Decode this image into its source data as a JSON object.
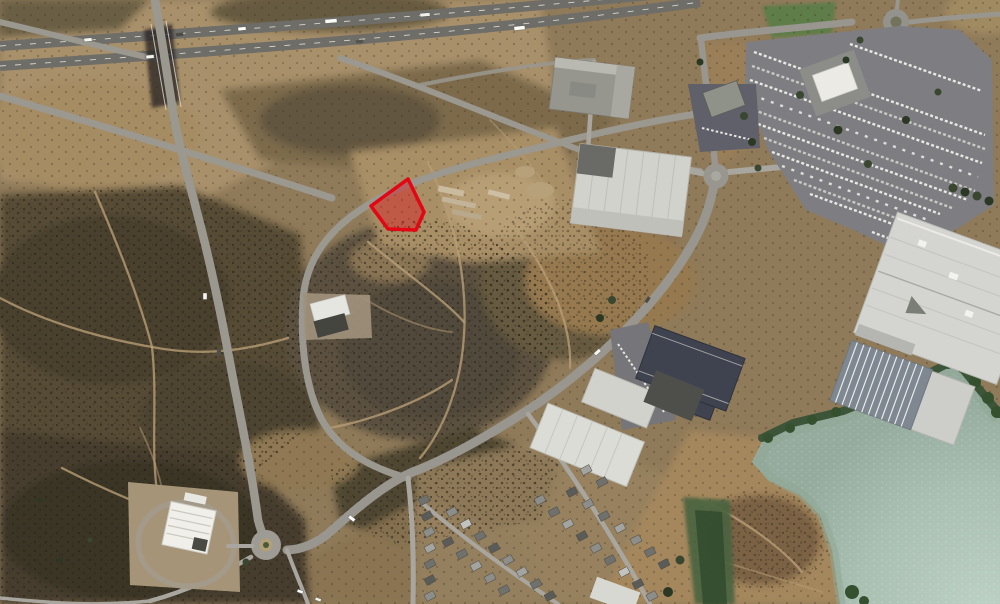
{
  "image": {
    "width": 1000,
    "height": 604,
    "kind": "aerial-satellite-photo"
  },
  "colors": {
    "land_base": "#8f7a59",
    "scrub_dark": "#4a4130",
    "dirt_light": "#b49c74",
    "road": "#9a988f",
    "highway": "#6e6d68",
    "water": "#a9bfb2",
    "water_near_shore": "#8fa795",
    "vegetation": "#3c5538",
    "roof_light": "#d5d5d1",
    "roof_dark": "#3f4350",
    "lawn": "#5f7d48"
  },
  "parcel": {
    "points": "408,179 371,206 388,229 416,230 424,212",
    "stroke": "#e30613",
    "fill": "rgba(227,6,19,0.38)"
  },
  "features": {
    "interchange": "freeway interchange with overpass",
    "highway": "dual-carriageway freeway",
    "loop_road": "oval loop road around vacant scrubland",
    "parcel_overlay": "red outlined land parcel beside loop road",
    "shopping_centre": "large white-roof retail centre with car park",
    "service_station": "service station with canopy and loop driveway",
    "residential": "housing estate",
    "water": "lake shoreline"
  }
}
